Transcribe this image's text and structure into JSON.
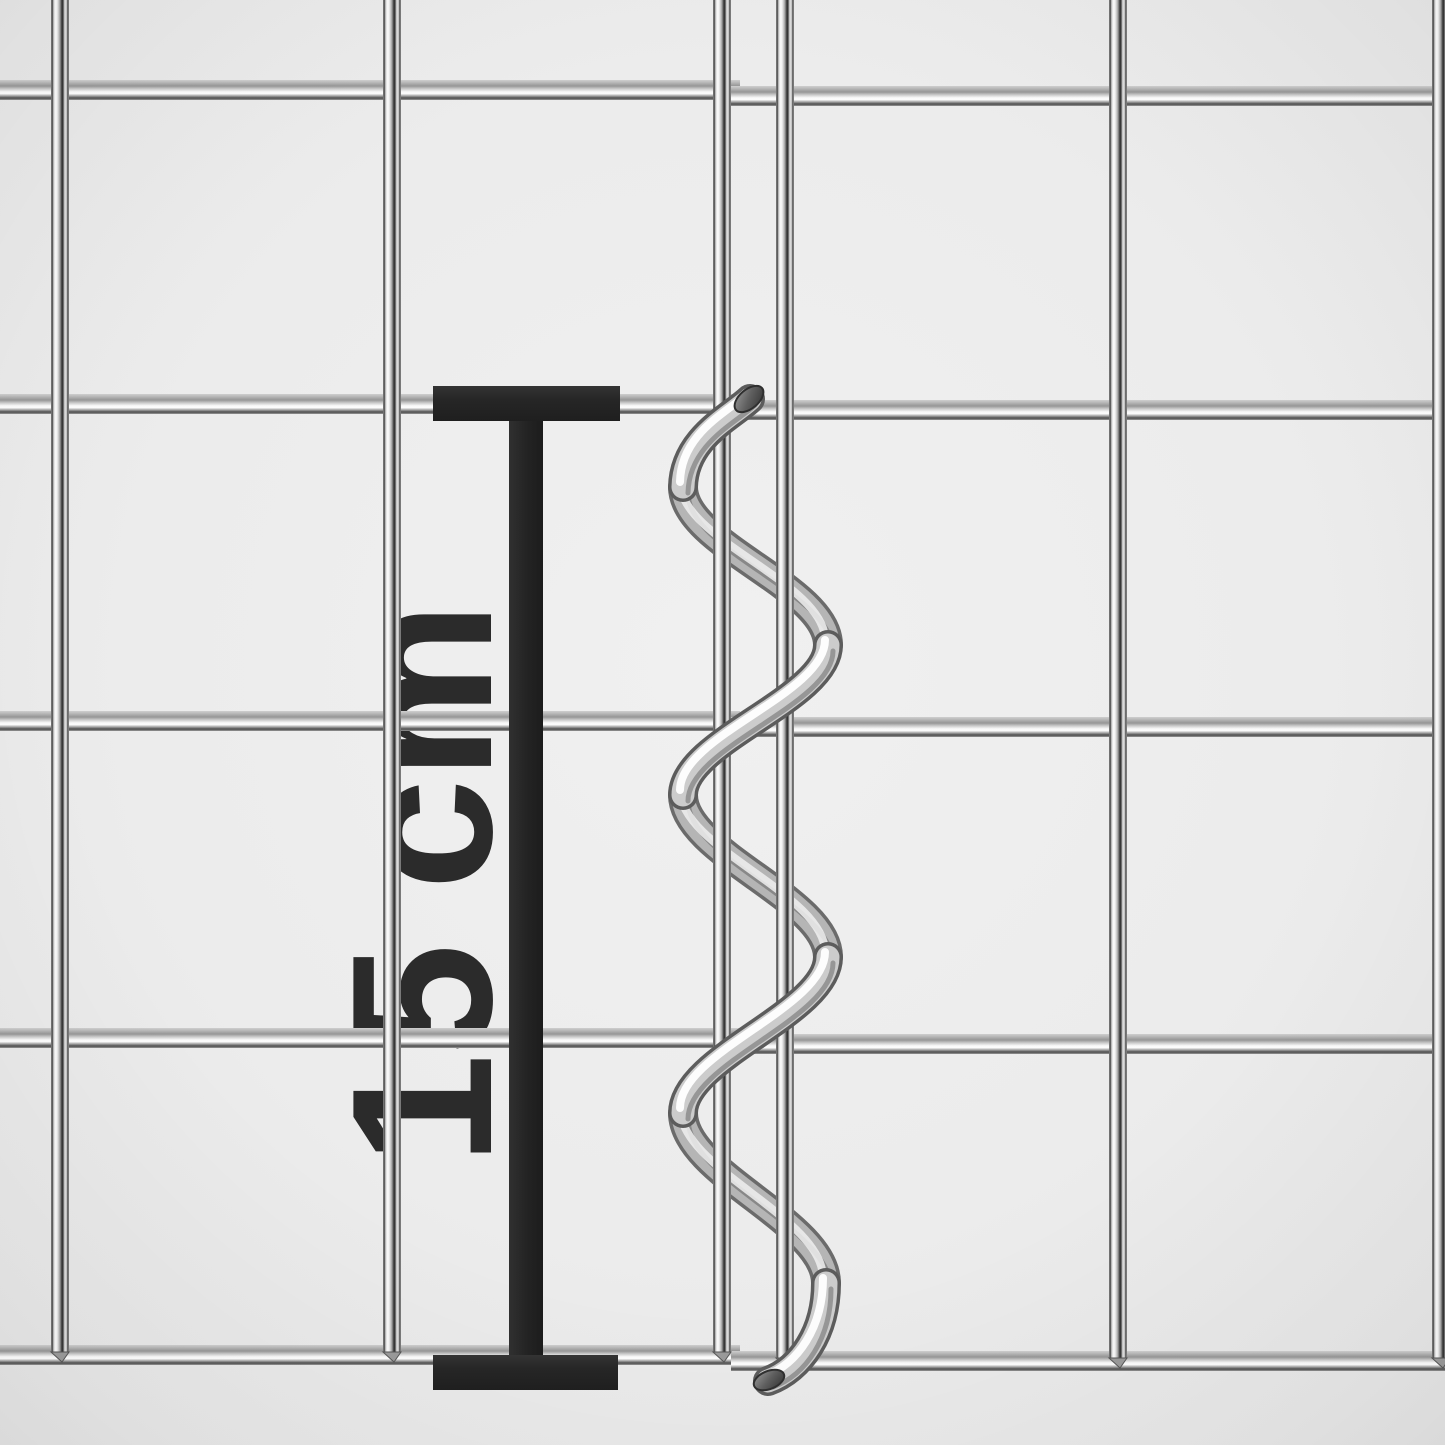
{
  "annotation": {
    "dimension_label": "15 cm",
    "value": "15",
    "unit": "cm"
  },
  "colors": {
    "background": "#ececec",
    "marker": "#262626",
    "label_text": "#2b2b2b",
    "chrome_highlight": "#ffffff",
    "chrome_mid": "#c9c9c9",
    "chrome_shadow": "#3c3c3c"
  },
  "mesh": {
    "wire_thickness": {
      "vertical": 18,
      "horizontal": 20
    },
    "left_panel": {
      "vertical_wires_x": [
        60,
        392,
        722
      ],
      "horizontal_wires_y": [
        90,
        404,
        721,
        1038,
        1355
      ],
      "horizontal_span": [
        -4,
        740
      ],
      "vertical_span": [
        -4,
        1352
      ]
    },
    "right_panel": {
      "vertical_wires_x": [
        785,
        1118,
        1441
      ],
      "horizontal_wires_y": [
        96,
        410,
        727,
        1044,
        1361
      ],
      "horizontal_span": [
        731,
        1449
      ],
      "vertical_span": [
        -4,
        1358
      ]
    }
  },
  "spiral": {
    "turns": 3,
    "center_x": 755,
    "top_y": 399,
    "bottom_y": 1381
  }
}
